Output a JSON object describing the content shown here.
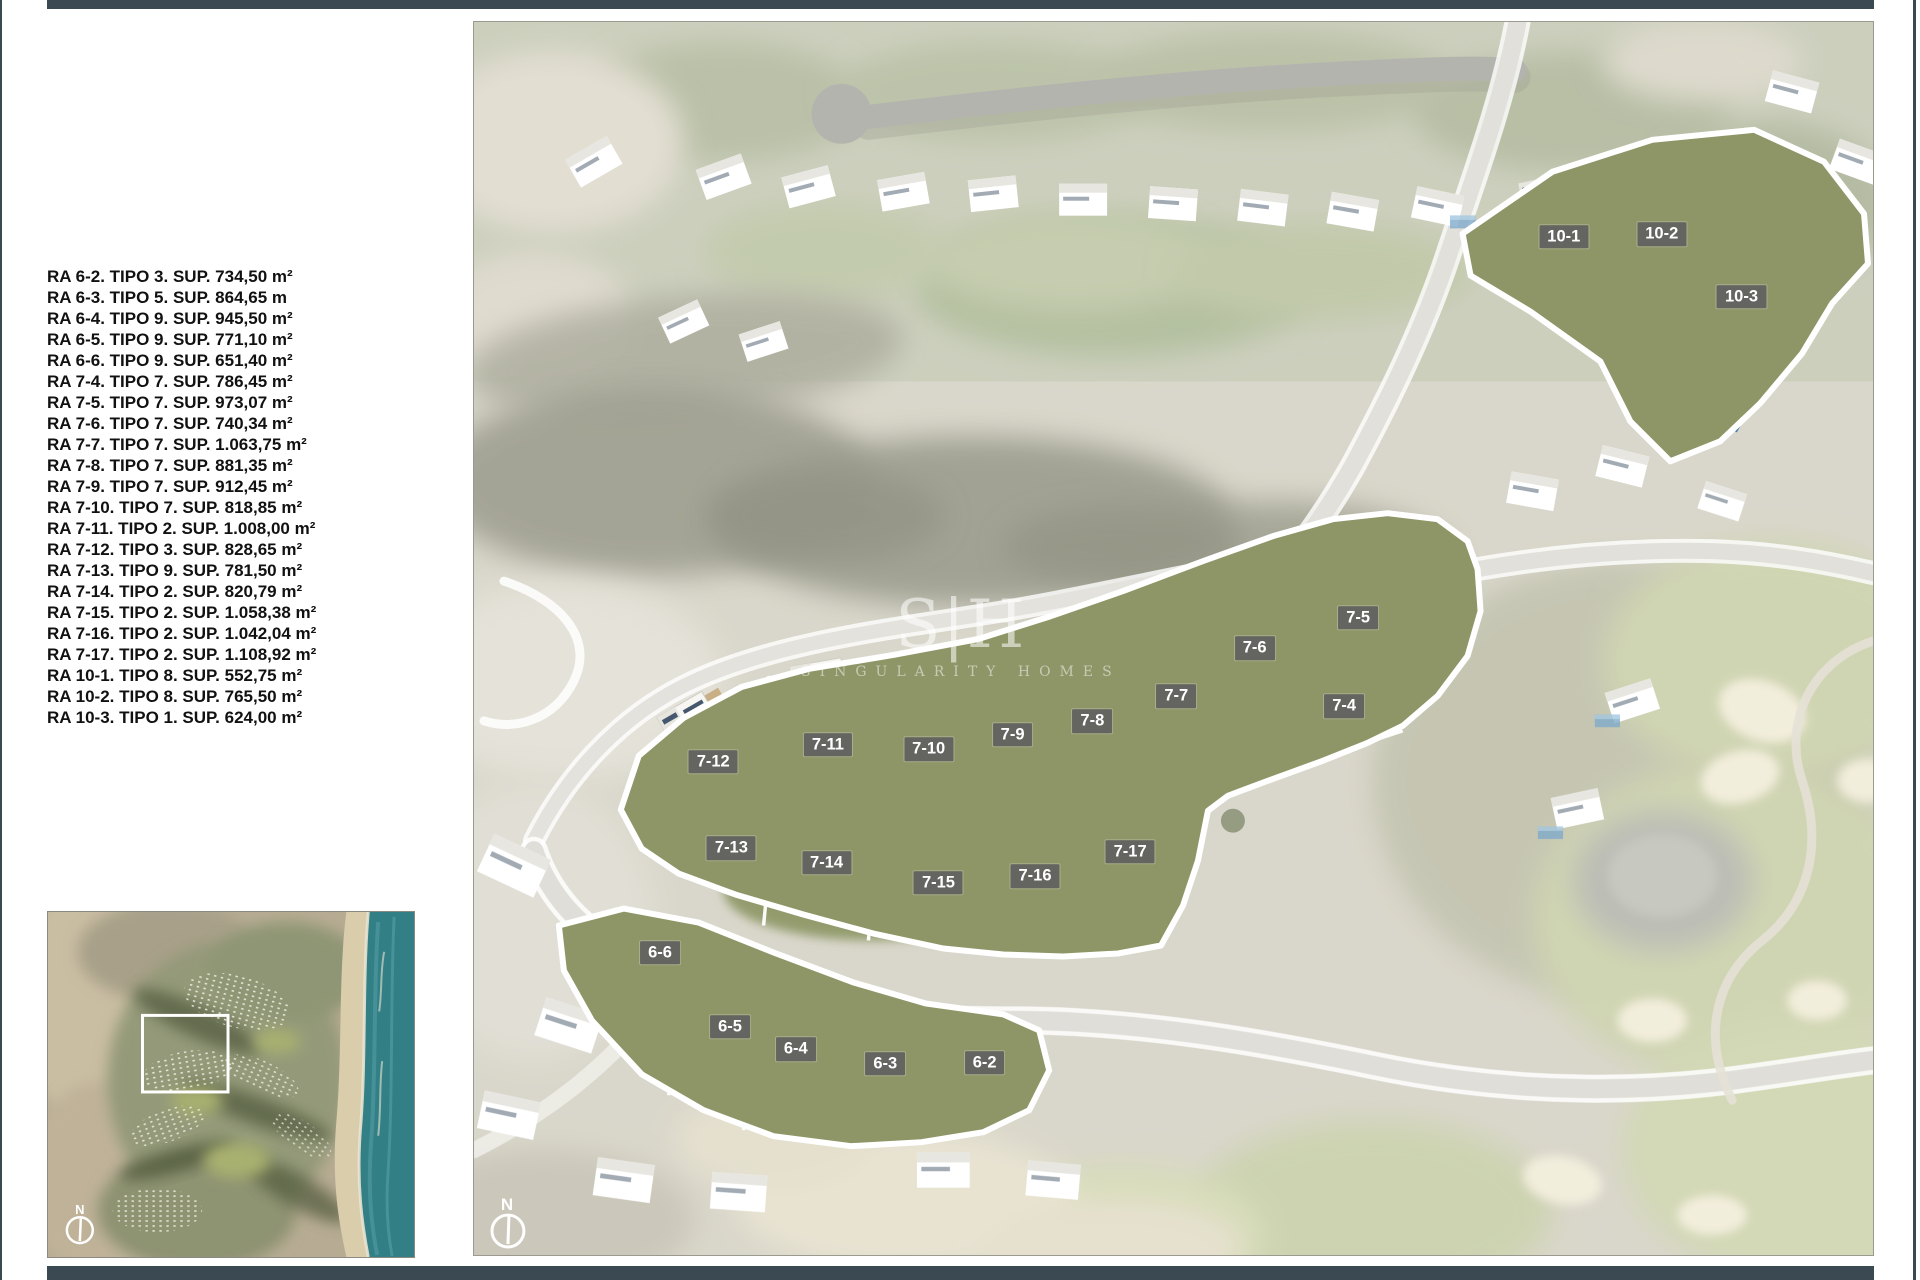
{
  "page": {
    "frame_color": "#3b4a52",
    "background": "#ffffff"
  },
  "legend": {
    "items": [
      "RA 6-2. TIPO 3. SUP. 734,50 m²",
      "RA 6-3. TIPO 5. SUP. 864,65 m",
      "RA 6-4. TIPO 9. SUP. 945,50 m²",
      "RA 6-5. TIPO 9. SUP. 771,10 m²",
      "RA 6-6. TIPO 9. SUP. 651,40 m²",
      "RA 7-4. TIPO 7. SUP. 786,45 m²",
      "RA 7-5. TIPO 7. SUP. 973,07 m²",
      "RA 7-6. TIPO 7. SUP. 740,34 m²",
      "RA 7-7. TIPO 7. SUP. 1.063,75 m²",
      "RA 7-8. TIPO 7. SUP. 881,35 m²",
      "RA 7-9. TIPO 7. SUP. 912,45 m²",
      "RA 7-10. TIPO 7. SUP. 818,85 m²",
      "RA 7-11. TIPO 2. SUP. 1.008,00 m²",
      "RA 7-12. TIPO 3. SUP. 828,65 m²",
      "RA 7-13. TIPO 9. SUP. 781,50 m²",
      "RA 7-14. TIPO 2. SUP. 820,79 m²",
      "RA 7-15. TIPO 2. SUP. 1.058,38 m²",
      "RA 7-16. TIPO 2. SUP. 1.042,04 m²",
      "RA 7-17. TIPO 2. SUP. 1.108,92 m²",
      "RA 10-1. TIPO 8. SUP. 552,75 m²",
      "RA 10-2. TIPO 8. SUP. 765,50 m²",
      "RA 10-3. TIPO 1. SUP. 624,00 m²"
    ]
  },
  "watermark": {
    "logo": "S|H",
    "name": "SINGULARITY HOMES"
  },
  "main_map": {
    "compass_label": "N",
    "plots": [
      {
        "id": "10-1",
        "x_pct": 77.9,
        "y_pct": 17.4
      },
      {
        "id": "10-2",
        "x_pct": 84.9,
        "y_pct": 17.2
      },
      {
        "id": "10-3",
        "x_pct": 90.6,
        "y_pct": 22.3
      },
      {
        "id": "7-5",
        "x_pct": 63.2,
        "y_pct": 48.3
      },
      {
        "id": "7-6",
        "x_pct": 55.8,
        "y_pct": 50.8
      },
      {
        "id": "7-7",
        "x_pct": 50.2,
        "y_pct": 54.7
      },
      {
        "id": "7-4",
        "x_pct": 62.2,
        "y_pct": 55.5
      },
      {
        "id": "7-8",
        "x_pct": 44.2,
        "y_pct": 56.7
      },
      {
        "id": "7-9",
        "x_pct": 38.5,
        "y_pct": 57.8
      },
      {
        "id": "7-10",
        "x_pct": 32.5,
        "y_pct": 59.0
      },
      {
        "id": "7-11",
        "x_pct": 25.3,
        "y_pct": 58.6
      },
      {
        "id": "7-12",
        "x_pct": 17.1,
        "y_pct": 60.0
      },
      {
        "id": "7-13",
        "x_pct": 18.4,
        "y_pct": 67.0
      },
      {
        "id": "7-14",
        "x_pct": 25.2,
        "y_pct": 68.2
      },
      {
        "id": "7-15",
        "x_pct": 33.2,
        "y_pct": 69.8
      },
      {
        "id": "7-16",
        "x_pct": 40.1,
        "y_pct": 69.3
      },
      {
        "id": "7-17",
        "x_pct": 46.9,
        "y_pct": 67.3
      },
      {
        "id": "6-6",
        "x_pct": 13.3,
        "y_pct": 75.5
      },
      {
        "id": "6-5",
        "x_pct": 18.3,
        "y_pct": 81.5
      },
      {
        "id": "6-4",
        "x_pct": 23.0,
        "y_pct": 83.3
      },
      {
        "id": "6-3",
        "x_pct": 29.4,
        "y_pct": 84.5
      },
      {
        "id": "6-2",
        "x_pct": 36.5,
        "y_pct": 84.4
      }
    ]
  },
  "inset_map": {
    "compass_label": "N"
  },
  "colors": {
    "chip_background": "#616161",
    "chip_text": "#ffffff",
    "cluster_outline": "#ffffff",
    "pool_blue": "#3f7fb0",
    "golf_green": "#b7bf8b",
    "bunker_sand": "#ece5ca",
    "ocean_teal": "#337f86"
  }
}
